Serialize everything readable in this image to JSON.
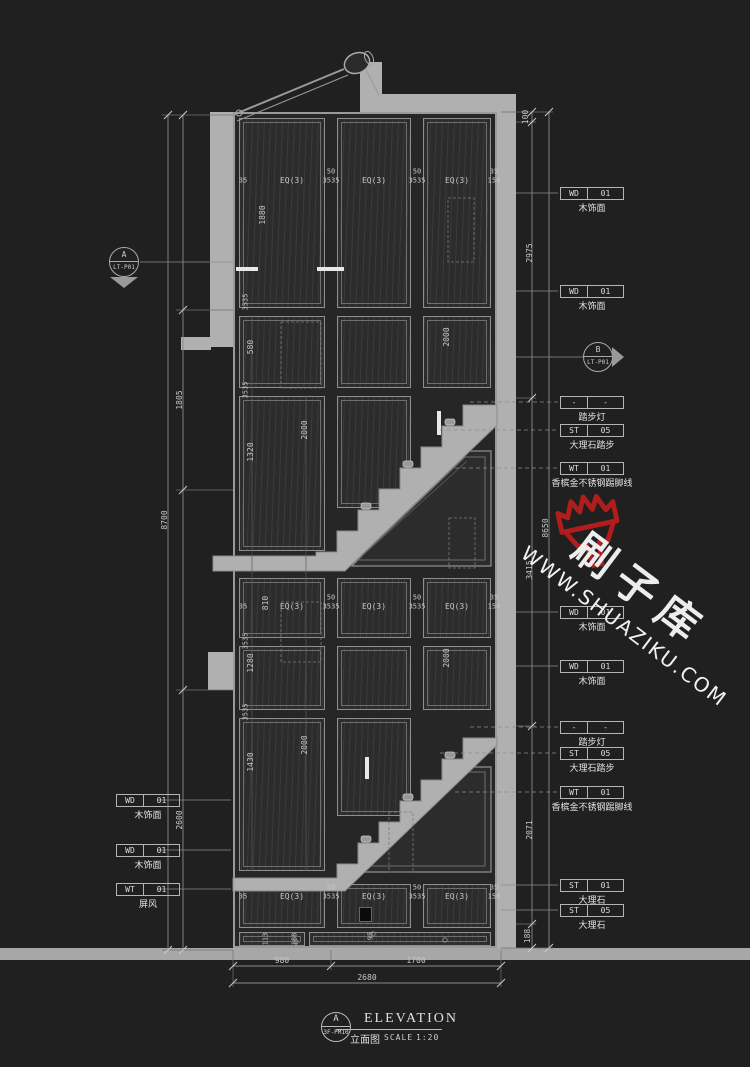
{
  "page": {
    "background": "#202020",
    "structure_gray": "#b0b0b0",
    "panel_color": "#2c2c2c"
  },
  "title_block": {
    "marker_letter": "A",
    "marker_code": "3F-PM10",
    "title": "ELEVATION",
    "title_cn": "立面图",
    "scale_label": "SCALE",
    "scale_value": "1:20"
  },
  "section_markers": {
    "left": {
      "letter": "A",
      "code": "LT-P01"
    },
    "right": {
      "letter": "B",
      "code": "LT-P01"
    }
  },
  "watermark": {
    "site_cn": "刷子库",
    "site_url": "WWW.SHUAZIKU.COM",
    "brush_color": "#b01d1d",
    "text_color": "#ededed"
  },
  "annotations": {
    "right": [
      {
        "tag": "WD",
        "num": "01",
        "cn": "木饰面",
        "y": 187
      },
      {
        "tag": "WD",
        "num": "01",
        "cn": "木饰面",
        "y": 285
      },
      {
        "tag": "-",
        "num": "-",
        "cn": "踏步灯",
        "y": 396
      },
      {
        "tag": "ST",
        "num": "05",
        "cn": "大理石踏步",
        "y": 424
      },
      {
        "tag": "WT",
        "num": "01",
        "cn": "香槟金不锈钢踢脚线",
        "y": 462
      },
      {
        "tag": "WD",
        "num": "01",
        "cn": "木饰面",
        "y": 606
      },
      {
        "tag": "WD",
        "num": "01",
        "cn": "木饰面",
        "y": 660
      },
      {
        "tag": "-",
        "num": "-",
        "cn": "踏步灯",
        "y": 721
      },
      {
        "tag": "ST",
        "num": "05",
        "cn": "大理石踏步",
        "y": 747
      },
      {
        "tag": "WT",
        "num": "01",
        "cn": "香槟金不锈钢踢脚线",
        "y": 786
      },
      {
        "tag": "ST",
        "num": "01",
        "cn": "大理石",
        "y": 879
      },
      {
        "tag": "ST",
        "num": "05",
        "cn": "大理石",
        "y": 904
      }
    ],
    "left": [
      {
        "tag": "WD",
        "num": "01",
        "cn": "木饰面",
        "y": 794
      },
      {
        "tag": "WD",
        "num": "01",
        "cn": "木饰面",
        "y": 844
      },
      {
        "tag": "WT",
        "num": "01",
        "cn": "屏风",
        "y": 883
      }
    ]
  },
  "dimensions": {
    "texts": [
      {
        "t": "EQ(3)",
        "x": 292,
        "y": 181
      },
      {
        "t": "EQ(3)",
        "x": 374,
        "y": 181
      },
      {
        "t": "EQ(3)",
        "x": 457,
        "y": 181
      },
      {
        "t": "EQ(3)",
        "x": 292,
        "y": 607
      },
      {
        "t": "EQ(3)",
        "x": 374,
        "y": 607
      },
      {
        "t": "EQ(3)",
        "x": 457,
        "y": 607
      },
      {
        "t": "EQ(3)",
        "x": 292,
        "y": 897
      },
      {
        "t": "EQ(3)",
        "x": 374,
        "y": 897
      },
      {
        "t": "EQ(3)",
        "x": 457,
        "y": 897
      },
      {
        "t": "50",
        "x": 331,
        "y": 172,
        "s": 7
      },
      {
        "t": "3535",
        "x": 331,
        "y": 181,
        "s": 7
      },
      {
        "t": "50",
        "x": 417,
        "y": 172,
        "s": 7
      },
      {
        "t": "3535",
        "x": 417,
        "y": 181,
        "s": 7
      },
      {
        "t": "35",
        "x": 243,
        "y": 181,
        "s": 7
      },
      {
        "t": "35",
        "x": 494,
        "y": 172,
        "s": 7
      },
      {
        "t": "150",
        "x": 494,
        "y": 181,
        "s": 7
      },
      {
        "t": "50",
        "x": 331,
        "y": 598,
        "s": 7
      },
      {
        "t": "3535",
        "x": 331,
        "y": 607,
        "s": 7
      },
      {
        "t": "50",
        "x": 417,
        "y": 598,
        "s": 7
      },
      {
        "t": "3535",
        "x": 417,
        "y": 607,
        "s": 7
      },
      {
        "t": "35",
        "x": 243,
        "y": 607,
        "s": 7
      },
      {
        "t": "35",
        "x": 494,
        "y": 598,
        "s": 7
      },
      {
        "t": "150",
        "x": 494,
        "y": 607,
        "s": 7
      },
      {
        "t": "50",
        "x": 331,
        "y": 888,
        "s": 7
      },
      {
        "t": "3535",
        "x": 331,
        "y": 897,
        "s": 7
      },
      {
        "t": "50",
        "x": 417,
        "y": 888,
        "s": 7
      },
      {
        "t": "3535",
        "x": 417,
        "y": 897,
        "s": 7
      },
      {
        "t": "35",
        "x": 243,
        "y": 897,
        "s": 7
      },
      {
        "t": "35",
        "x": 494,
        "y": 888,
        "s": 7
      },
      {
        "t": "150",
        "x": 494,
        "y": 897,
        "s": 7
      },
      {
        "t": "980",
        "x": 282,
        "y": 961
      },
      {
        "t": "1700",
        "x": 416,
        "y": 961
      },
      {
        "t": "2680",
        "x": 367,
        "y": 978
      },
      {
        "t": "1880",
        "x": 263,
        "y": 215,
        "rot": -90
      },
      {
        "t": "580",
        "x": 251,
        "y": 347,
        "rot": -90
      },
      {
        "t": "2000",
        "x": 447,
        "y": 337,
        "rot": -90
      },
      {
        "t": "1320",
        "x": 251,
        "y": 452,
        "rot": -90
      },
      {
        "t": "2000",
        "x": 305,
        "y": 430,
        "rot": -90
      },
      {
        "t": "810",
        "x": 266,
        "y": 603,
        "rot": -90
      },
      {
        "t": "1280",
        "x": 251,
        "y": 663,
        "rot": -90
      },
      {
        "t": "2000",
        "x": 447,
        "y": 658,
        "rot": -90
      },
      {
        "t": "1430",
        "x": 251,
        "y": 762,
        "rot": -90
      },
      {
        "t": "2000",
        "x": 305,
        "y": 745,
        "rot": -90
      },
      {
        "t": "1805",
        "x": 180,
        "y": 400,
        "rot": -90
      },
      {
        "t": "8700",
        "x": 165,
        "y": 520,
        "rot": -90
      },
      {
        "t": "2600",
        "x": 180,
        "y": 820,
        "rot": -90
      },
      {
        "t": "100",
        "x": 526,
        "y": 117,
        "rot": -90
      },
      {
        "t": "2975",
        "x": 530,
        "y": 253,
        "rot": -90
      },
      {
        "t": "3415",
        "x": 530,
        "y": 570,
        "rot": -90
      },
      {
        "t": "8650",
        "x": 546,
        "y": 528,
        "rot": -90
      },
      {
        "t": "2071",
        "x": 530,
        "y": 830,
        "rot": -90
      },
      {
        "t": "188",
        "x": 528,
        "y": 936,
        "rot": -90
      },
      {
        "t": "113",
        "x": 266,
        "y": 939,
        "rot": -90,
        "s": 7
      },
      {
        "t": "188",
        "x": 295,
        "y": 939,
        "rot": -90,
        "s": 7
      },
      {
        "t": "95",
        "x": 371,
        "y": 936,
        "rot": -90,
        "s": 7
      },
      {
        "t": "3535",
        "x": 246,
        "y": 302,
        "rot": -90,
        "s": 7
      },
      {
        "t": "3535",
        "x": 246,
        "y": 390,
        "rot": -90,
        "s": 7
      },
      {
        "t": "3535",
        "x": 246,
        "y": 641,
        "rot": -90,
        "s": 7
      },
      {
        "t": "3535",
        "x": 246,
        "y": 712,
        "rot": -90,
        "s": 7
      }
    ]
  }
}
